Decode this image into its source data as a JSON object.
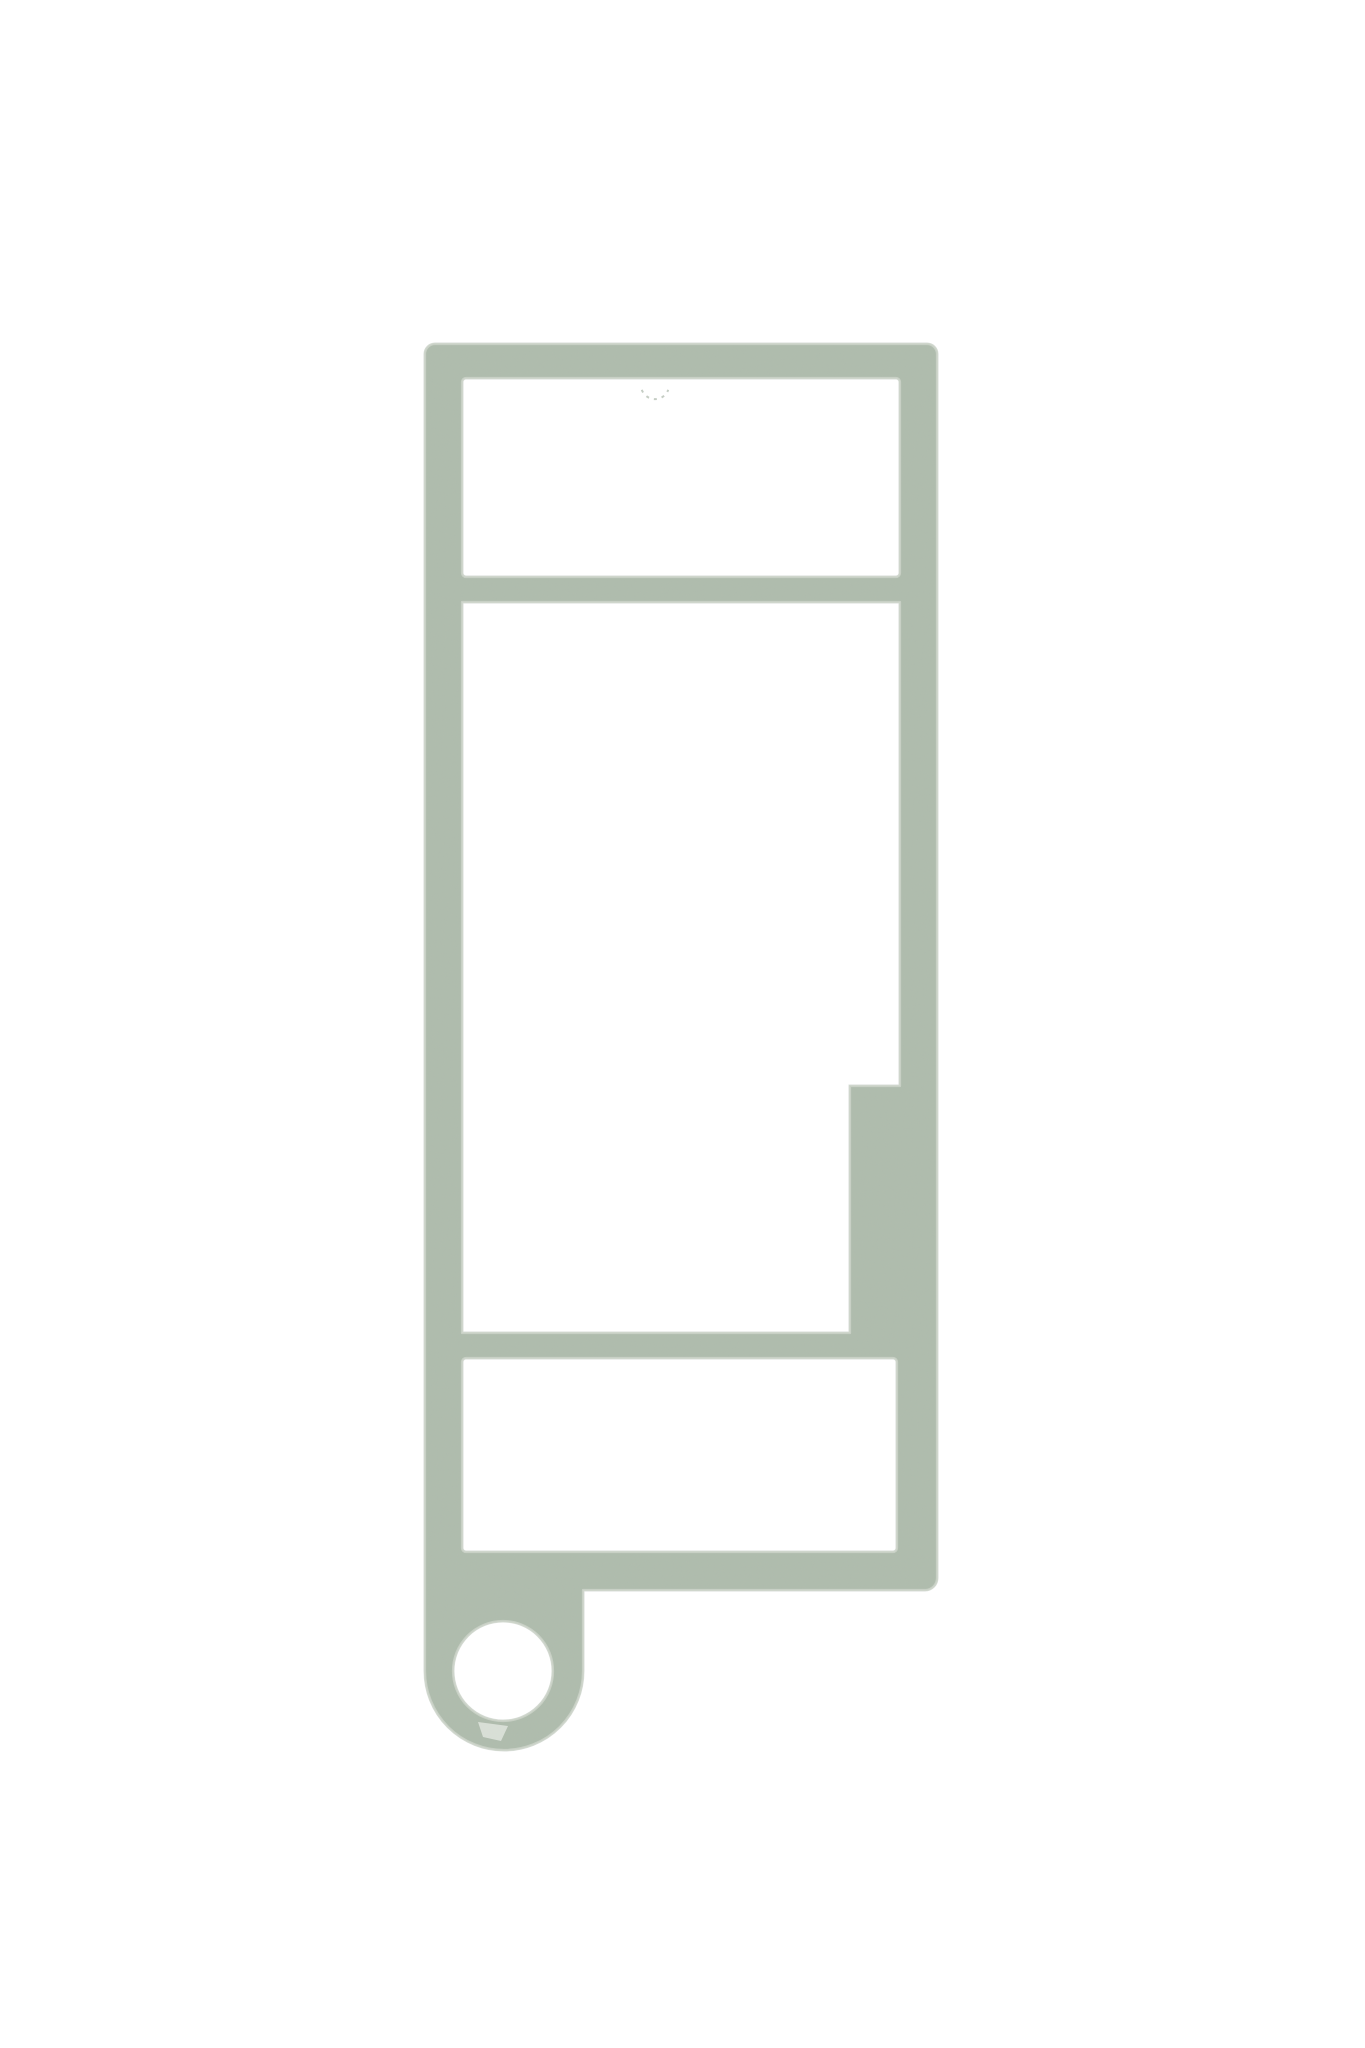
{
  "scene": {
    "description": "3D render of a sage-green flat keychain frame blank on a plain white background: tall rectangular frame with three rectangular window cutouts, a stepped wider section on the lower right rail, and a round keyring loop at the bottom left",
    "background_color": "#ffffff"
  },
  "colors": {
    "body_fill": "#afbcad",
    "edge_highlight": "#ccd4c9",
    "edge_shadow": "#8fa08e",
    "grain_tint_r": 0.45,
    "grain_tint_g": 0.5,
    "grain_tint_b": 0.44,
    "artifact_light": "#dde2da",
    "artifact_smudge": "#b7c1b5"
  },
  "geometry": {
    "canvas": {
      "width": 1365,
      "height": 2048
    },
    "outer": {
      "left": 425,
      "top": 344,
      "right": 937,
      "bottom": 1590,
      "corner_radius_top": 10,
      "corner_radius_bottom_right": 12
    },
    "tab": {
      "right_edge_x": 583,
      "ring_center_x": 504,
      "ring_center_y": 1671,
      "ring_outer_radius": 79
    },
    "keyring_hole": {
      "cx": 503,
      "cy": 1671,
      "r": 50
    },
    "windows": [
      {
        "name": "top-window",
        "type": "rect",
        "x": 462,
        "y": 378,
        "w": 438,
        "h": 199,
        "r": 4
      },
      {
        "name": "main-window",
        "type": "poly",
        "points": [
          [
            462,
            602
          ],
          [
            900,
            602
          ],
          [
            900,
            1086
          ],
          [
            850,
            1086
          ],
          [
            850,
            1333
          ],
          [
            462,
            1333
          ]
        ]
      },
      {
        "name": "bottom-window",
        "type": "rect",
        "x": 462,
        "y": 1358,
        "w": 435,
        "h": 194,
        "r": 4
      }
    ],
    "artifacts": [
      {
        "name": "top-window-smudge",
        "type": "arc",
        "cx": 655,
        "cy": 385,
        "r": 14,
        "sweep_deg_start": 200,
        "sweep_deg_end": 340
      },
      {
        "name": "keyring-chip",
        "type": "chip",
        "points": [
          [
            478,
            1722
          ],
          [
            508,
            1726
          ],
          [
            501,
            1741
          ],
          [
            483,
            1737
          ]
        ]
      }
    ]
  }
}
